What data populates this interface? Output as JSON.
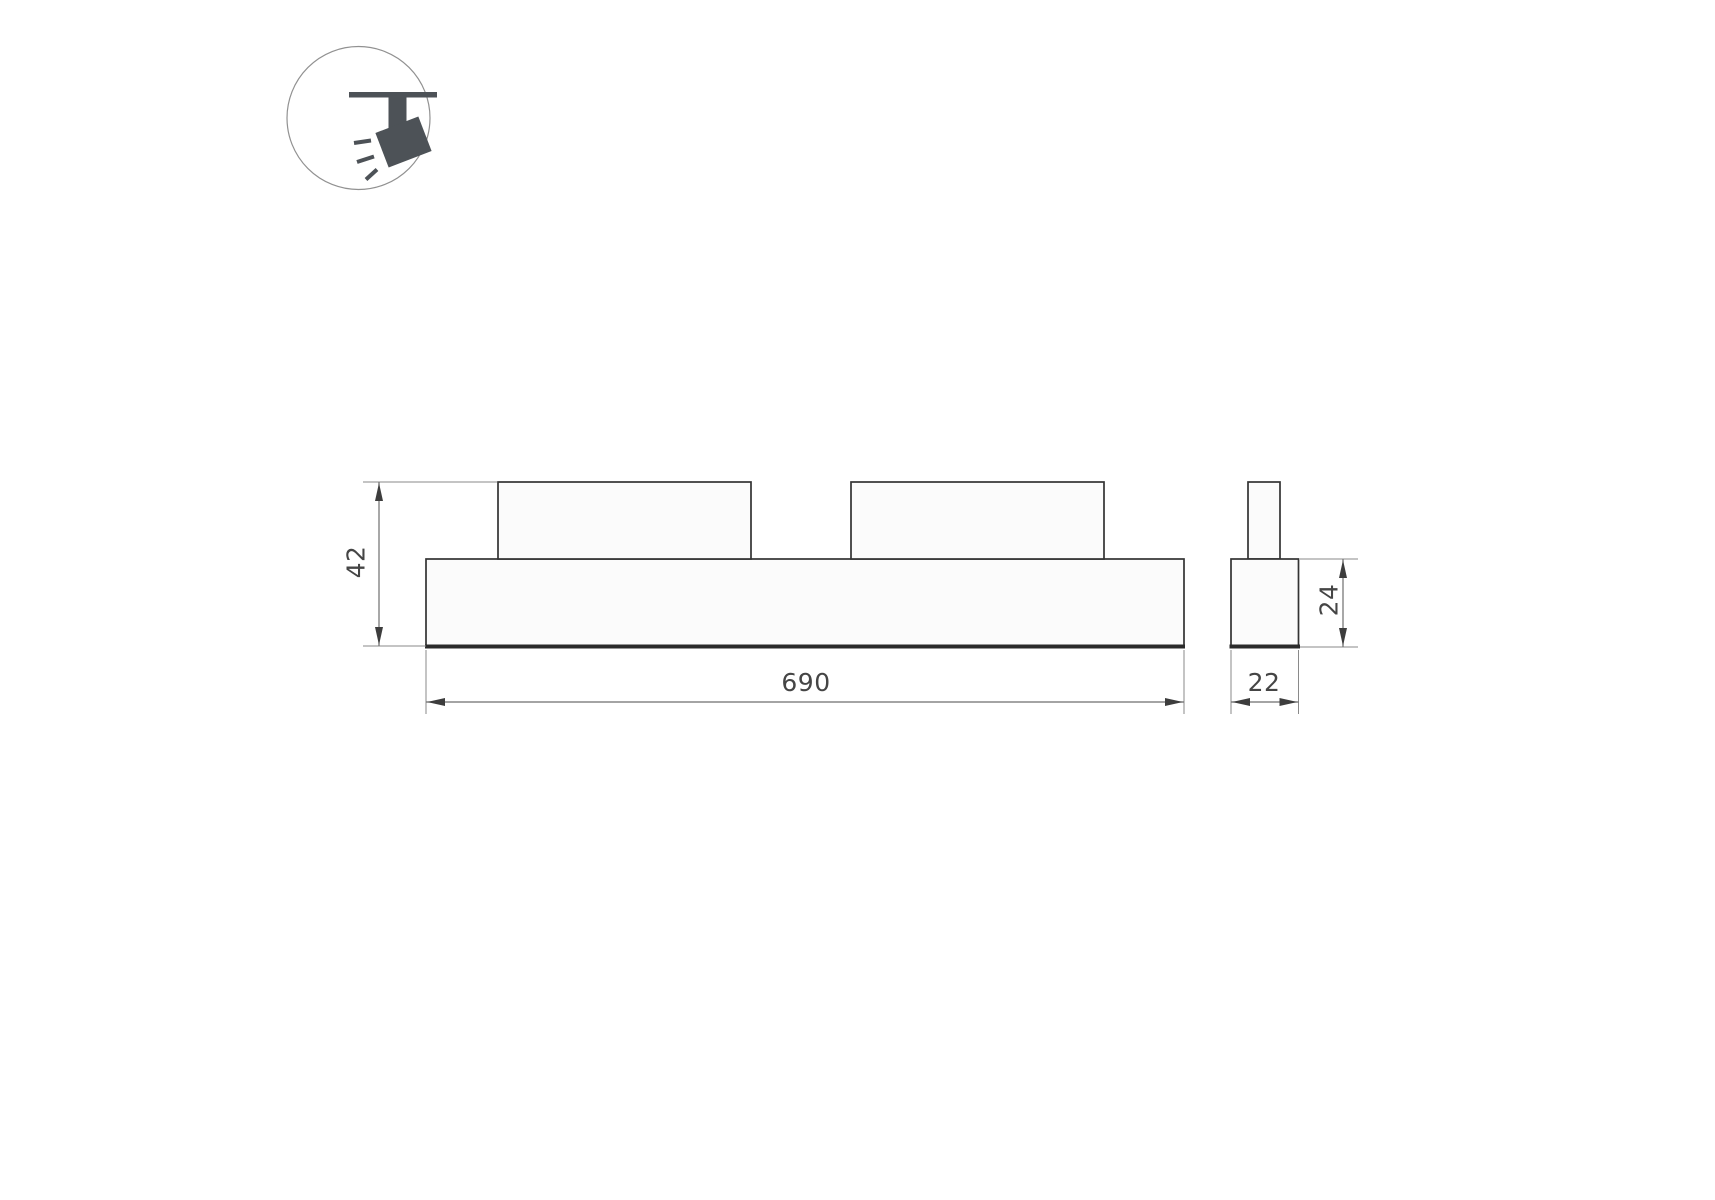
{
  "icon": {
    "type": "ceiling-track-spotlight-icon"
  },
  "dimensions": {
    "front_width": "690",
    "front_height": "42",
    "side_width": "22",
    "side_height": "24"
  },
  "colors": {
    "background": "#ffffff",
    "outline": "#333333",
    "thick_edge": "#2b2b2b",
    "dimension_lines": "#6e6e6e",
    "extension_lines": "#8a8a8a",
    "arrowheads": "#3d3d3d",
    "text": "#454545",
    "icon_fill": "#4d5257",
    "shape_fill": "#fbfbfb"
  }
}
